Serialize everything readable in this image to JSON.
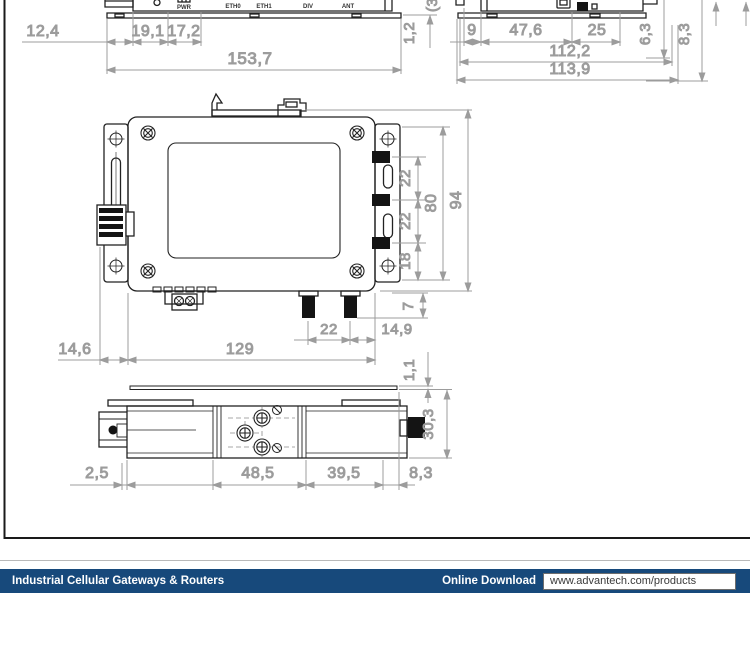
{
  "drawing": {
    "front_panel_view": {
      "port_labels": [
        "PWR",
        "ETH0",
        "ETH1",
        "DIV",
        "ANT"
      ],
      "dims": {
        "plate_offset": "12,4",
        "pwr_offset": "19,1",
        "eth_offset": "17,2",
        "overall_width": "153,7",
        "plate_thickness": "1,2",
        "clipped_dim": "(3"
      }
    },
    "side_view": {
      "dims": {
        "bracket": "9",
        "front_section": "47,6",
        "rear_section": "25",
        "inner_width": "112,2",
        "overall_width": "113,9",
        "step_a": "6,3",
        "step_b": "8,3"
      }
    },
    "rear_view": {
      "dims": {
        "conn_pitch_1": "22",
        "conn_pitch_2": "22",
        "conn_offset": "18",
        "bracket_holes": "80",
        "overall_height": "94",
        "antenna_pitch": "22",
        "antenna_offset": "14,9",
        "antenna_protrusion": "7",
        "body_offset": "14,6",
        "body_width": "129"
      }
    },
    "bottom_view": {
      "dims": {
        "plate_thickness": "1,1",
        "edge_gap": "2,5",
        "mid_section": "48,5",
        "right_section": "39,5",
        "connector_offset": "8,3",
        "overall_depth": "30,3"
      }
    }
  },
  "footer": {
    "category": "Industrial Cellular Gateways & Routers",
    "download_label": "Online Download",
    "url": "www.advantech.com/products",
    "bar_color": "#17497b",
    "url_text_color": "#3a3a3a"
  }
}
